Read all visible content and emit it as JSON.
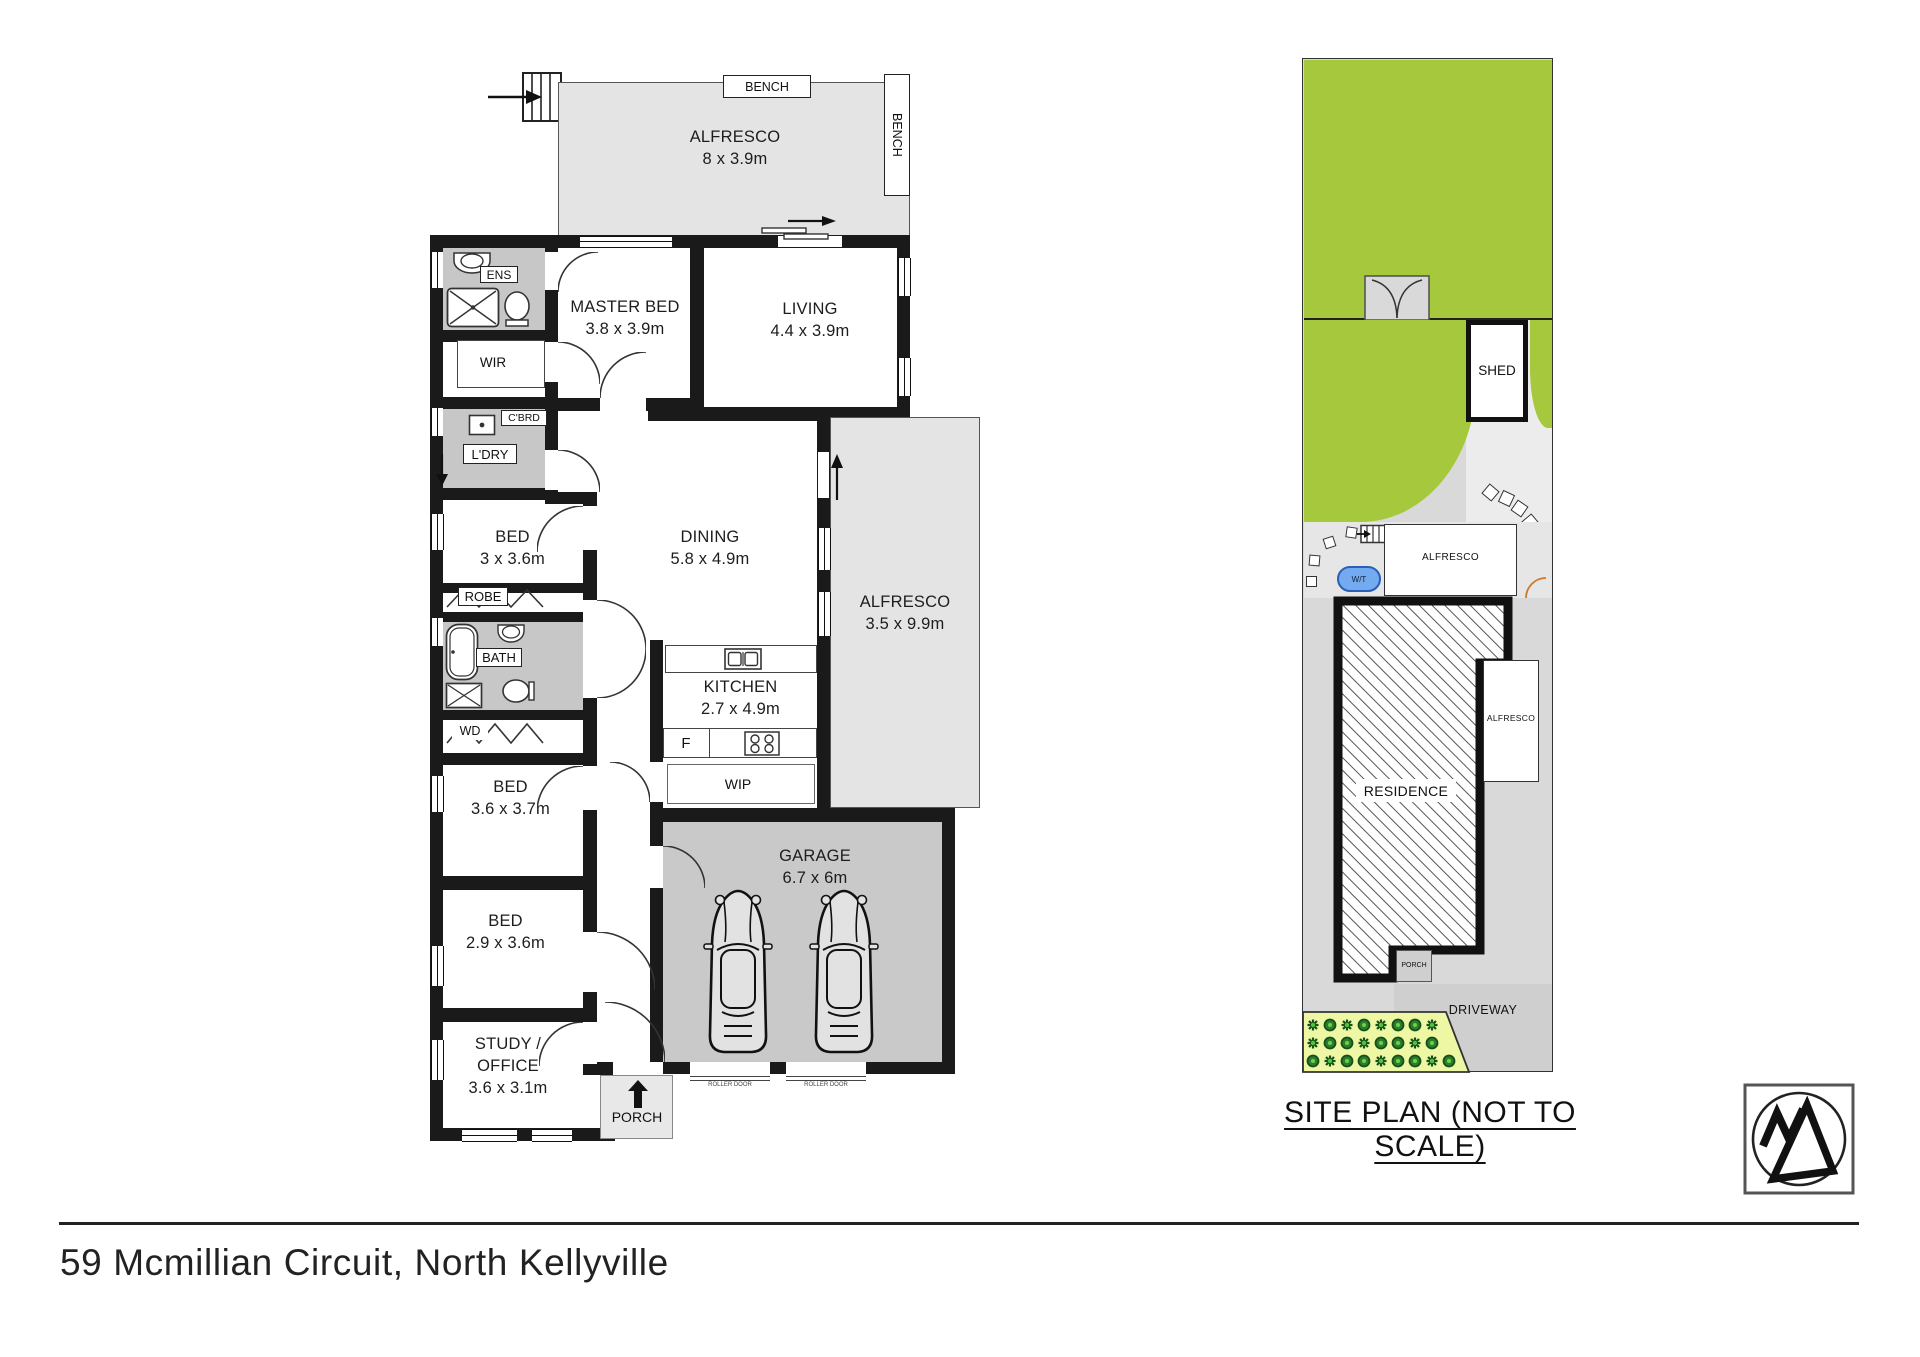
{
  "footer": {
    "address": "59 Mcmillian Circuit, North Kellyville"
  },
  "floor_plan": {
    "bench_top": "BENCH",
    "bench_right": "BENCH",
    "rooms": {
      "alfresco_top": {
        "name": "ALFRESCO",
        "dims": "8 x 3.9m"
      },
      "master_bed": {
        "name": "MASTER BED",
        "dims": "3.8 x 3.9m"
      },
      "living": {
        "name": "LIVING",
        "dims": "4.4 x 3.9m"
      },
      "dining": {
        "name": "DINING",
        "dims": "5.8 x 4.9m"
      },
      "kitchen": {
        "name": "KITCHEN",
        "dims": "2.7 x 4.9m"
      },
      "alfresco_right": {
        "name": "ALFRESCO",
        "dims": "3.5 x 9.9m"
      },
      "garage": {
        "name": "GARAGE",
        "dims": "6.7 x 6m"
      },
      "bed_1": {
        "name": "BED",
        "dims": "3 x 3.6m"
      },
      "bed_2": {
        "name": "BED",
        "dims": "3.6 x 3.7m"
      },
      "bed_3": {
        "name": "BED",
        "dims": "2.9 x 3.6m"
      },
      "study": {
        "name": "STUDY / OFFICE",
        "dims": "3.6 x 3.1m"
      }
    },
    "labels": {
      "ens": "ENS",
      "wir": "WIR",
      "cbrd": "C'BRD",
      "ldry": "L'DRY",
      "robe": "ROBE",
      "bath": "BATH",
      "wd": "WD",
      "wip": "WIP",
      "fridge": "F",
      "porch": "PORCH",
      "roller_door": "ROLLER DOOR"
    }
  },
  "site_plan": {
    "caption": "SITE PLAN (NOT TO SCALE)",
    "labels": {
      "shed": "SHED",
      "alfresco_upper": "ALFRESCO",
      "water_tank": "W/T",
      "residence": "RESIDENCE",
      "alfresco_side": "ALFRESCO",
      "porch": "PORCH",
      "driveway": "DRIVEWAY"
    }
  },
  "colors": {
    "wall": "#1a1a1a",
    "alfresco_fill": "#e4e4e4",
    "garage_fill": "#c9c9c9",
    "wet_area_fill": "#c7c7c7",
    "lawn": "#a5c83d",
    "garden_bed": "#eef8a4",
    "water_tank_fill": "#74aaf0",
    "site_paving": "#d9d9d9",
    "driveway": "#cfcfcf"
  }
}
